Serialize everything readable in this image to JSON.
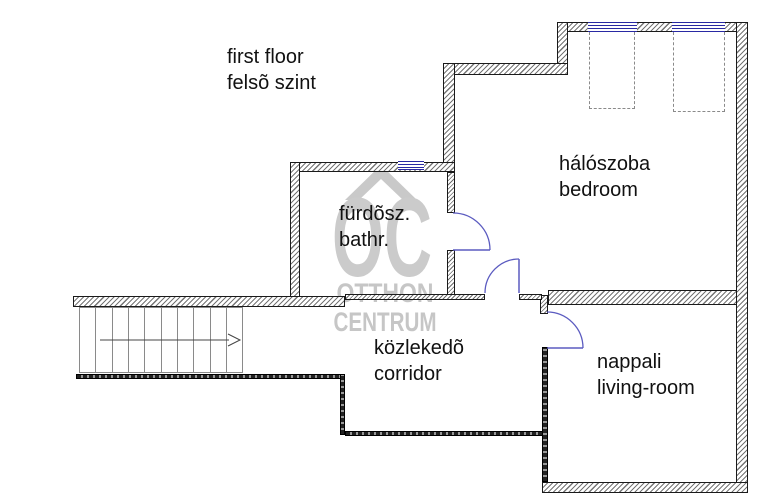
{
  "title": {
    "line1": "first floor",
    "line2": "felsõ szint"
  },
  "rooms": {
    "bathroom": {
      "name_local": "fürdõsz.",
      "name_en": "bathr."
    },
    "bedroom": {
      "name_local": "hálószoba",
      "name_en": "bedroom"
    },
    "corridor": {
      "name_local": "közlekedõ",
      "name_en": "corridor"
    },
    "living_room": {
      "name_local": "nappali",
      "name_en": "living-room"
    }
  },
  "watermark": {
    "logo": "OC",
    "line1": "OTTHON",
    "line2": "CENTRUM"
  },
  "colors": {
    "door_arc": "#5b5bc0",
    "window": "#2929a3",
    "wall_outline": "#1a1a1a",
    "watermark_gray": "#c8c8c8"
  }
}
